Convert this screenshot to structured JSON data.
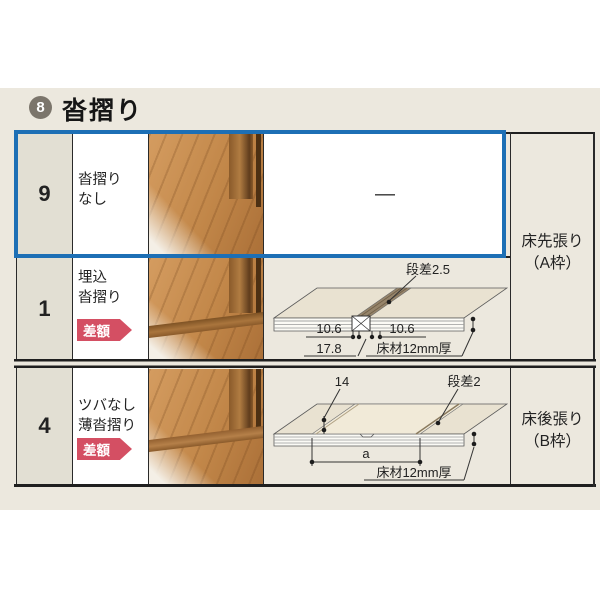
{
  "header": {
    "badge_number": "8",
    "title": "沓摺り"
  },
  "rows": [
    {
      "num": "9",
      "name_line1": "沓摺り",
      "name_line2": "なし",
      "cell_text": "—",
      "selected": true
    },
    {
      "num": "1",
      "name_line1": "埋込",
      "name_line2": "沓摺り",
      "badge": "差額"
    },
    {
      "num": "4",
      "name_line1": "ツバなし",
      "name_line2": "薄沓摺り",
      "badge": "差額"
    }
  ],
  "group_labels": {
    "a_line1": "床先張り",
    "a_line2": "（A枠）",
    "b_line1": "床後張り",
    "b_line2": "（B枠）"
  },
  "diagram_embedded_sill": {
    "step_label": "段差2.5",
    "dim_left": "10.6",
    "dim_right": "10.6",
    "dim_total": "17.8",
    "floor_label": "床材12mm厚"
  },
  "diagram_thin_sill": {
    "dim_width": "14",
    "step_label": "段差2",
    "dim_span": "a",
    "floor_label": "床材12mm厚"
  },
  "colors": {
    "highlight_blue": "#1d6fb5",
    "badge_red": "#d44f63",
    "panel_beige": "#ece8de",
    "number_cell": "#e2dfd3"
  }
}
